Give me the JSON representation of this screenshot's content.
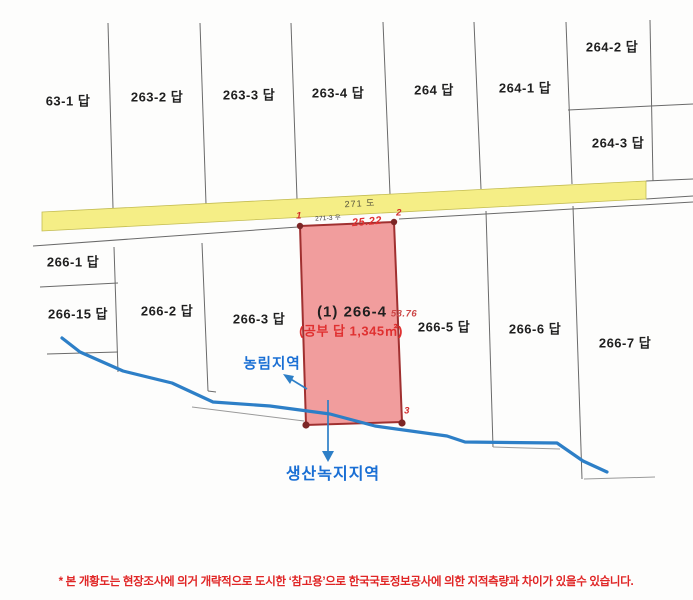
{
  "parcels": {
    "p63_1": "63-1 답",
    "p263_2": "263-2 답",
    "p263_3": "263-3 답",
    "p263_4": "263-4 답",
    "p264": "264 답",
    "p264_1": "264-1 답",
    "p264_2": "264-2 답",
    "p264_3": "264-3 답",
    "p266_1": "266-1 답",
    "p266_15": "266-15 답",
    "p266_2": "266-2 답",
    "p266_3": "266-3 답",
    "p266_5": "266-5 답",
    "p266_6": "266-6 답",
    "p266_7": "266-7 답"
  },
  "road": {
    "label": "271 도",
    "adjacent_parcel_label": "271-3 우",
    "fill_color": "#f5ee86"
  },
  "subject_parcel": {
    "number_label": "(1) 266-4",
    "area_label": "(공부 답 1,345㎡)",
    "top_edge_length": "25.22",
    "right_edge_length": "53.76",
    "vertex_1": "1",
    "vertex_2": "2",
    "vertex_3": "3",
    "fill_color": "#ee8888",
    "border_color": "#a03030"
  },
  "zoning": {
    "agriculture_forest": "농림지역",
    "production_green": "생산녹지지역",
    "label_color": "#1a6fd4"
  },
  "stream_color": "#2d7fc7",
  "footnote": "* 본 개황도는 현장조사에 의거 개략적으로 도시한 ‘참고용’으로 한국국토정보공사에 의한 지적측량과 차이가 있을수 있습니다."
}
